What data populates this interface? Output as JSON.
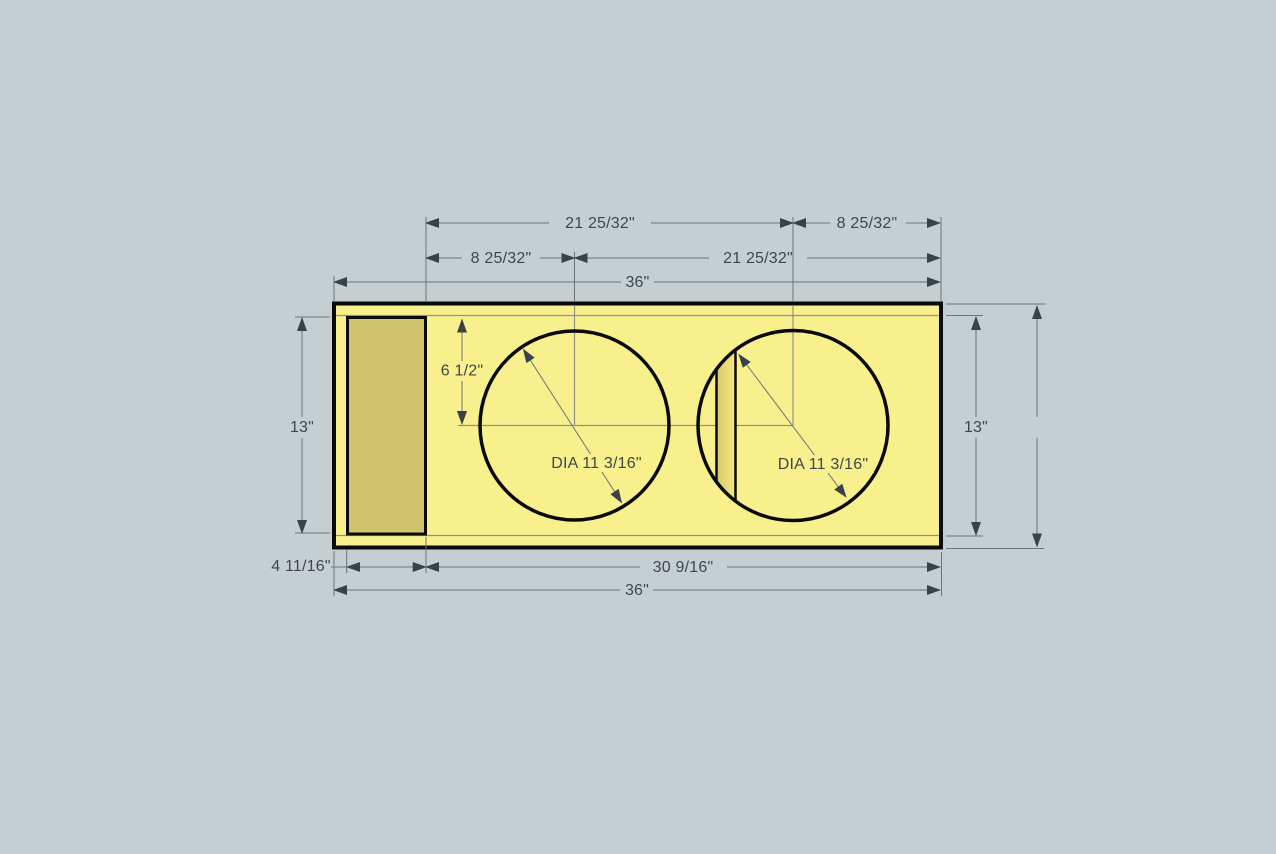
{
  "app": {
    "view_name": "speaker-enclosure-front-panel-drawing"
  },
  "colors": {
    "background": "#c5ced0",
    "panel_face": "#f8ef8d",
    "port_inside": "#d1c36e",
    "brace_shade_dark": "#d8c96e",
    "brace_shade_light": "#f3e982",
    "outline": "#0a0a0a",
    "dimension_line": "#6b7479",
    "centerline": "#8f9287",
    "arrow": "#3b4247",
    "text": "#40474b"
  },
  "drawing": {
    "type": "dimensioned-front-view",
    "dim_labels": {
      "top_row1_left": "21 25/32\"",
      "top_row1_right": "8 25/32\"",
      "top_row2_left": "8 25/32\"",
      "top_row2_right": "21 25/32\"",
      "top_overall_width": "36\"",
      "left_inner_height": "13\"",
      "driver_center_offset": "6 1/2\"",
      "driver_left_diameter": "DIA 11 3/16\"",
      "driver_right_diameter": "DIA 11 3/16\"",
      "right_inner_height": "13\"",
      "right_overall_height": "14 1/2\"",
      "bottom_port_width": "4 11/16\"",
      "bottom_right_span": "30 9/16\"",
      "bottom_overall_width": "36\""
    }
  }
}
